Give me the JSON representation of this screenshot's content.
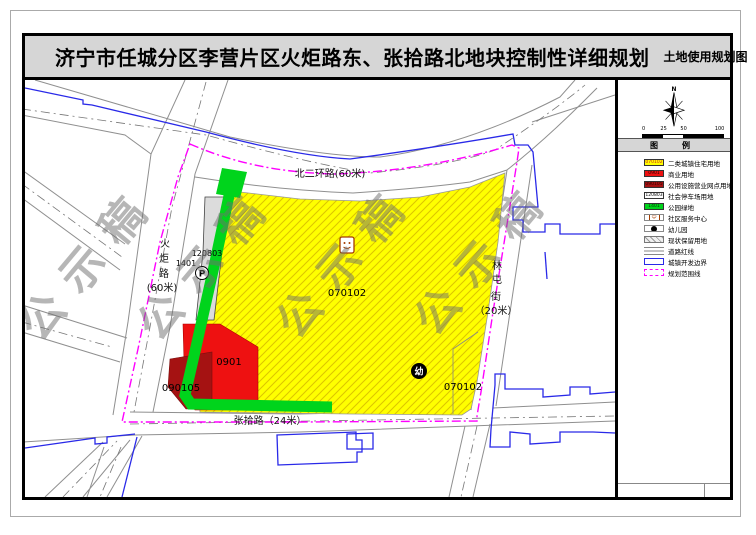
{
  "page": {
    "title": "济宁市任城分区李营片区火炬路东、张拾路北地块控制性详细规划",
    "map_type_label": "土地使用规划图"
  },
  "map": {
    "watermark": "公示稿",
    "roads": {
      "north_ring": "北二环路(60米)",
      "huoju_chars": [
        "火",
        "炬",
        "路",
        "(60米)"
      ],
      "zhangshi": "张拾路（24米）",
      "lintun_chars": [
        "林",
        "屯",
        "街",
        "（20米）"
      ]
    },
    "parcels": {
      "residential_main": "070102",
      "residential_se": "070102",
      "commercial": "0901",
      "utility_outlet": "090105",
      "parking": "120803",
      "park_green": "1401"
    },
    "markers": {
      "parking_glyph": "P",
      "kindergarten_glyph": "幼"
    }
  },
  "legend": {
    "header": "图　例",
    "items": [
      {
        "code": "070102",
        "label": "二类城镇住宅用地"
      },
      {
        "code": "0901",
        "label": "商业用地"
      },
      {
        "code": "090105",
        "label": "公用设施营业网点用地"
      },
      {
        "code": "120803",
        "label": "社会停车场用地"
      },
      {
        "code": "1401",
        "label": "公园绿地"
      },
      {
        "code": "",
        "label": "社区服务中心"
      },
      {
        "code": "",
        "label": "幼儿园"
      },
      {
        "code": "",
        "label": "现状保留用地"
      },
      {
        "code": "",
        "label": "道路红线"
      },
      {
        "code": "",
        "label": "城镇开发边界"
      },
      {
        "code": "",
        "label": "规划范围线"
      }
    ]
  },
  "compass": {
    "north_label": "N"
  },
  "scale_bar": {
    "labels": [
      "0",
      "25",
      "50",
      "100"
    ]
  },
  "colors": {
    "residential_yellow": "#ffff00",
    "commercial_red": "#ee1111",
    "utility_dark_red": "#a51212",
    "parking_gray": "#dcdcdc",
    "park_green": "#00d41c",
    "planning_boundary_magenta": "#ff00ff",
    "development_boundary_blue": "#2929e8"
  }
}
